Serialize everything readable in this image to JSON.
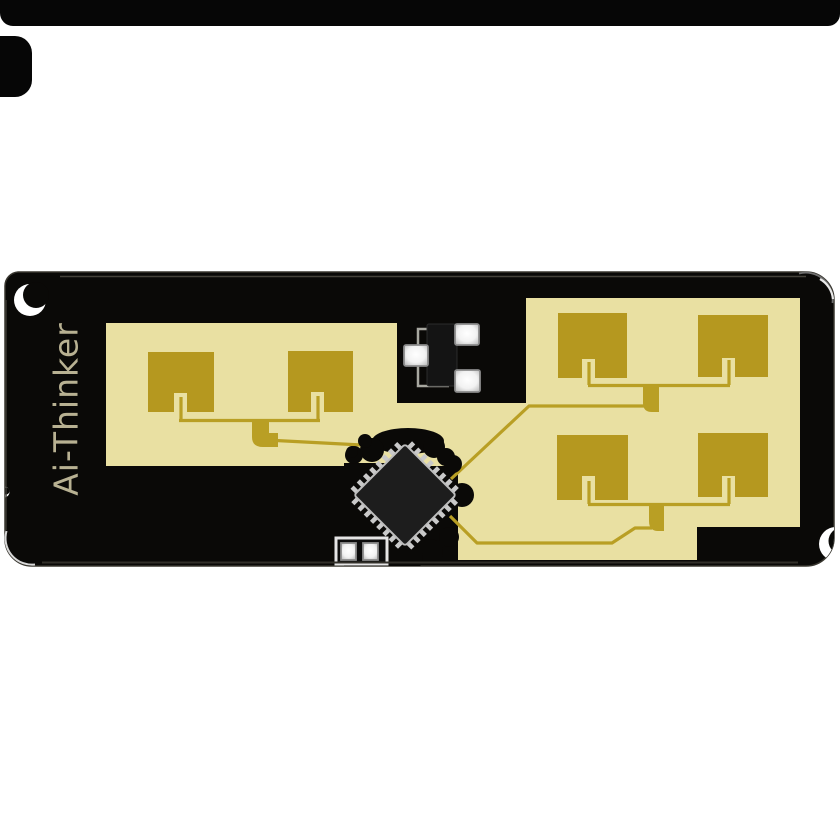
{
  "silkscreen": {
    "brand_text": "Ai-Thinker"
  },
  "board": {
    "antenna_patch_count": 6,
    "components": [
      "radar-soc-chip",
      "crystal-oscillator",
      "decoupling-capacitor"
    ],
    "edge_features": [
      "top-left-half-hole",
      "left-edge-half-hole",
      "right-edge-half-hole"
    ]
  },
  "colors": {
    "background": "#ffffff",
    "artifact_black": "#060606",
    "board": "#0a0907",
    "copper_pour": "#e9e0a2",
    "copper_patch": "#b5981f",
    "trace": "#b99f24",
    "silkscreen": "#b8b192",
    "pad": "#ffffff",
    "chip_body": "#1d1d1d",
    "chip_pin": "#c9c9c9"
  }
}
